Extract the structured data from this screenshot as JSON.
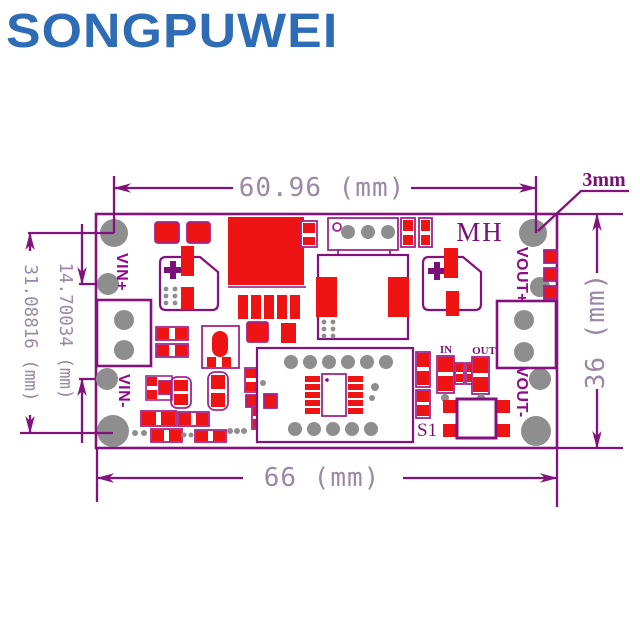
{
  "brand": {
    "logo_text": "SONGPUWEI"
  },
  "colors": {
    "logo_blue": "#2e6cb6",
    "line_purple": "#83127d",
    "component_red": "#ee1414",
    "component_outline": "#a0258f",
    "hole_gray": "#8e8e8e",
    "dim_text": "#9c88a6",
    "label_purple": "#7a0f78",
    "pin_label": "#90098a"
  },
  "dimensions": {
    "top_width": "60.96 (mm)",
    "hole_offset": "3mm",
    "left_outer_height": "31.08816 (mm)",
    "left_pin_spacing": "14.70034 (mm)",
    "bottom_width": "66 (mm)",
    "right_height": "36 (mm)"
  },
  "board": {
    "model": "MH",
    "pins": {
      "vin_plus": "VIN+",
      "vin_minus": "VIN-",
      "vout_plus": "VOUT+",
      "vout_minus": "VOUT-"
    },
    "indicators": {
      "led_in": "IN",
      "led_out": "OUT"
    },
    "switch": "S1"
  }
}
